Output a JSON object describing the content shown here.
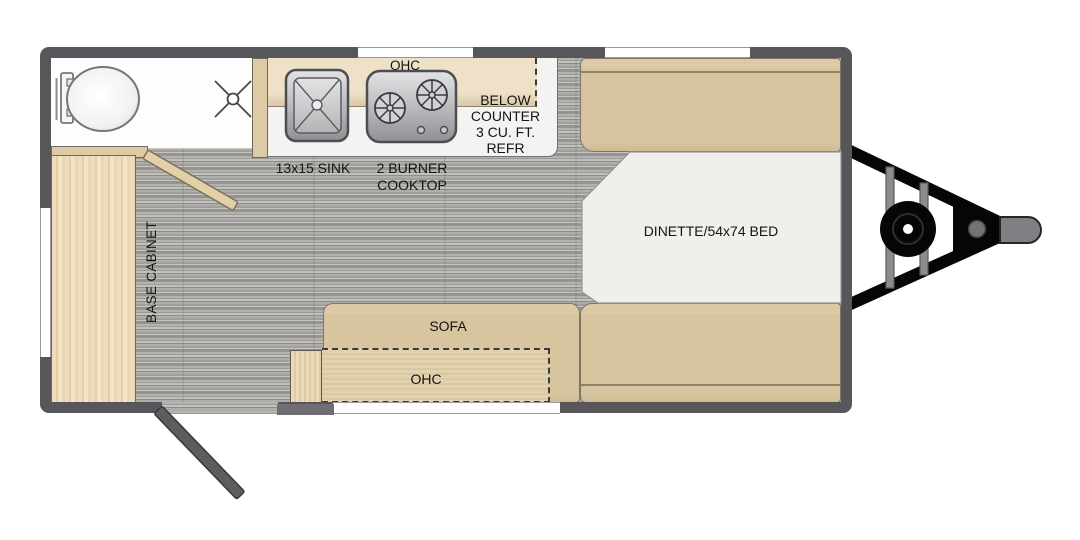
{
  "labels": {
    "kitchen_ohc": "OHC",
    "sink": "13x15 SINK",
    "cooktop_lines": [
      "2 BURNER",
      "COOKTOP"
    ],
    "refrigerator_lines": [
      "BELOW",
      "COUNTER",
      "3 CU. FT.",
      "REFR"
    ],
    "dinette": "DINETTE/54x74 BED",
    "sofa": "SOFA",
    "sofa_ohc": "OHC",
    "base_cabinet": "BASE CABINET"
  },
  "fixtures": {
    "toilet": "toilet",
    "shower_drain": "shower-drain",
    "sink_unit": "kitchen-sink",
    "cooktop_unit": "two-burner-cooktop",
    "bathroom_door": "bathroom-door-swing",
    "entry_door": "entry-door-swing",
    "hitch": "a-frame-tongue-hitch",
    "jack_wheel": "tongue-jack-wheel",
    "coupler": "hitch-coupler"
  },
  "colors": {
    "wall": "#57575b",
    "furniture_tan": "#d6c59e",
    "partition_tan": "#ddcba5",
    "cabinet_wood": "#ecdaba",
    "floor_grey": "#a9a7a4",
    "counter_white": "#f4f3f1",
    "table_white": "#f0efec",
    "hitch_black": "#060606",
    "hitch_grey": "#828286",
    "text": "#141414"
  }
}
